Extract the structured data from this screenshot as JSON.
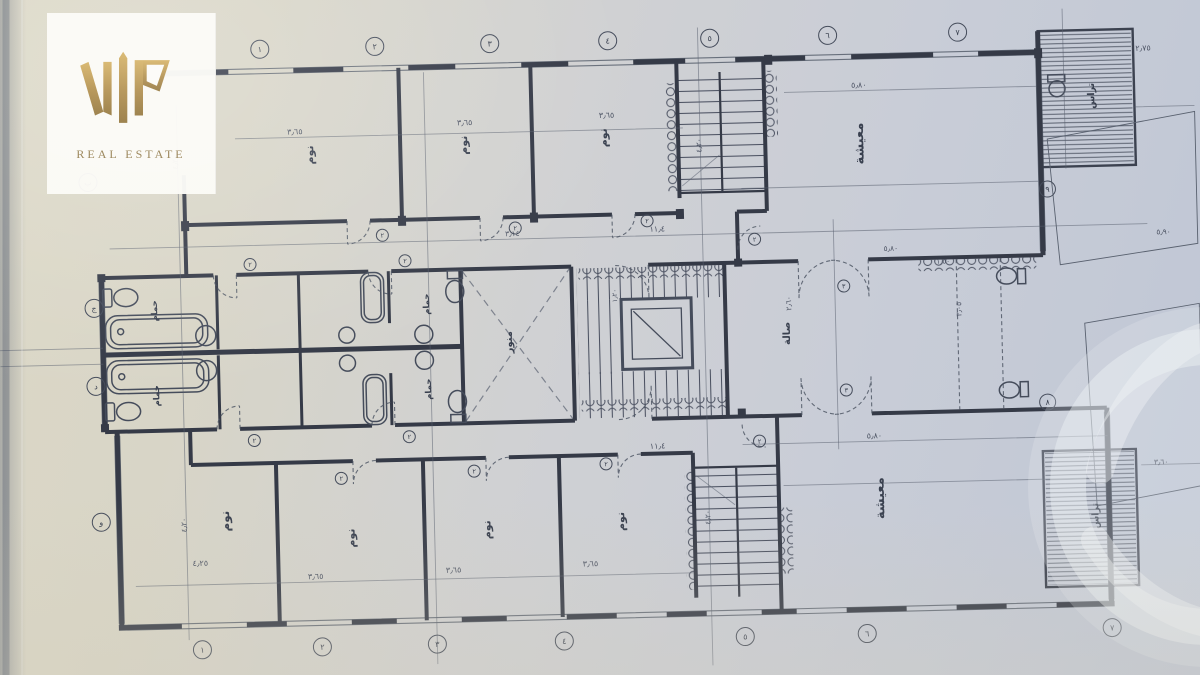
{
  "logo": {
    "monogram": "VIP",
    "subtitle": "REAL ESTATE",
    "gold": "#b08d3e",
    "panel_bg": "#fbfaf6"
  },
  "colors": {
    "paper_warm": "#dcd8c6",
    "paper_cool": "#bfc6d5",
    "ink": "#353a47",
    "thin_line": "#59616f",
    "watermark": "#eef1f4"
  },
  "plan": {
    "texts": [
      {
        "t": "معيشة",
        "x": 868,
        "y": 150,
        "r": -90,
        "s": 13,
        "k": "room"
      },
      {
        "t": "معيشة",
        "x": 880,
        "y": 505,
        "r": -90,
        "s": 13,
        "k": "room"
      },
      {
        "t": "نوم",
        "x": 318,
        "y": 148,
        "r": -90,
        "s": 11,
        "k": "room"
      },
      {
        "t": "نوم",
        "x": 472,
        "y": 142,
        "r": -90,
        "s": 11,
        "k": "room"
      },
      {
        "t": "نوم",
        "x": 612,
        "y": 138,
        "r": -90,
        "s": 11,
        "k": "room"
      },
      {
        "t": "نوم",
        "x": 225,
        "y": 512,
        "r": -90,
        "s": 12,
        "k": "room"
      },
      {
        "t": "نوم",
        "x": 350,
        "y": 532,
        "r": -90,
        "s": 11,
        "k": "room"
      },
      {
        "t": "نوم",
        "x": 486,
        "y": 527,
        "r": -90,
        "s": 11,
        "k": "room"
      },
      {
        "t": "نوم",
        "x": 620,
        "y": 522,
        "r": -90,
        "s": 11,
        "k": "room"
      },
      {
        "t": "منور",
        "x": 512,
        "y": 340,
        "r": -90,
        "s": 10,
        "k": "room"
      },
      {
        "t": "صالة",
        "x": 790,
        "y": 338,
        "r": -90,
        "s": 10,
        "k": "room"
      },
      {
        "t": "حمام",
        "x": 158,
        "y": 300,
        "r": -90,
        "s": 8.5,
        "k": "room"
      },
      {
        "t": "حمام",
        "x": 158,
        "y": 385,
        "r": -90,
        "s": 8.5,
        "k": "room"
      },
      {
        "t": "حمام",
        "x": 430,
        "y": 300,
        "r": -90,
        "s": 8.5,
        "k": "room"
      },
      {
        "t": "حمام",
        "x": 430,
        "y": 385,
        "r": -90,
        "s": 8.5,
        "k": "room"
      },
      {
        "t": "تراس",
        "x": 1100,
        "y": 108,
        "r": -90,
        "s": 9.5,
        "k": "room"
      },
      {
        "t": "تراس",
        "x": 1094,
        "y": 528,
        "r": -90,
        "s": 9.5,
        "k": "room"
      },
      {
        "t": "٣٫٦٥",
        "x": 300,
        "y": 127,
        "s": 8,
        "k": "dim"
      },
      {
        "t": "٣٫٦٥",
        "x": 470,
        "y": 122,
        "s": 8,
        "k": "dim"
      },
      {
        "t": "٣٫٦٥",
        "x": 612,
        "y": 118,
        "s": 8,
        "k": "dim"
      },
      {
        "t": "٥٫٨٠",
        "x": 865,
        "y": 94,
        "s": 8,
        "k": "dim"
      },
      {
        "t": "١١٫٤",
        "x": 660,
        "y": 233,
        "s": 8,
        "k": "dim"
      },
      {
        "t": "٣٫١٤",
        "x": 515,
        "y": 234,
        "s": 7.5,
        "k": "dim"
      },
      {
        "t": "٥٫٨٠",
        "x": 893,
        "y": 258,
        "s": 7.5,
        "k": "dim"
      },
      {
        "t": "١٫٥٠",
        "x": 945,
        "y": 272,
        "s": 7,
        "k": "dim"
      },
      {
        "t": "٥٫٨٠",
        "x": 872,
        "y": 445,
        "s": 8,
        "k": "dim"
      },
      {
        "t": "١١٫٤",
        "x": 655,
        "y": 450,
        "s": 8,
        "k": "dim"
      },
      {
        "t": "٣٫٦٥",
        "x": 310,
        "y": 572,
        "s": 8,
        "k": "dim"
      },
      {
        "t": "٣٫٦٥",
        "x": 448,
        "y": 569,
        "s": 8,
        "k": "dim"
      },
      {
        "t": "٣٫٦٥",
        "x": 585,
        "y": 566,
        "s": 8,
        "k": "dim"
      },
      {
        "t": "٤٫٢٥",
        "x": 195,
        "y": 556,
        "s": 8,
        "k": "dim"
      },
      {
        "t": "٢٫٧٥",
        "x": 1150,
        "y": 64,
        "s": 8,
        "k": "dim"
      },
      {
        "t": "٥٫٩٠",
        "x": 1166,
        "y": 248,
        "s": 7.5,
        "k": "dim"
      },
      {
        "t": "٣٫٦٠",
        "x": 1158,
        "y": 478,
        "s": 7.5,
        "k": "dim"
      },
      {
        "t": "٤٫٢٠",
        "x": 182,
        "y": 152,
        "r": -90,
        "s": 7.5,
        "k": "dim"
      },
      {
        "t": "٤٫٢٠",
        "x": 182,
        "y": 515,
        "r": -90,
        "s": 7.5,
        "k": "dim"
      },
      {
        "t": "٤٫٢٠",
        "x": 706,
        "y": 148,
        "r": -90,
        "s": 7.5,
        "k": "dim"
      },
      {
        "t": "٤٫٢٠",
        "x": 706,
        "y": 520,
        "r": -90,
        "s": 7.5,
        "k": "dim"
      },
      {
        "t": "٢٫٦٠",
        "x": 792,
        "y": 308,
        "r": -90,
        "s": 7.5,
        "k": "dim"
      },
      {
        "t": "٣٫٠٥",
        "x": 962,
        "y": 318,
        "r": -90,
        "s": 7.5,
        "k": "dim"
      },
      {
        "t": "١٫٢٠",
        "x": 618,
        "y": 296,
        "r": -90,
        "s": 7,
        "k": "dim"
      },
      {
        "t": "١",
        "x": 267,
        "y": 41,
        "c": 9,
        "s": 8,
        "k": "bub"
      },
      {
        "t": "٢",
        "x": 382,
        "y": 41,
        "c": 9,
        "s": 8,
        "k": "bub"
      },
      {
        "t": "٣",
        "x": 497,
        "y": 41,
        "c": 9,
        "s": 8,
        "k": "bub"
      },
      {
        "t": "٤",
        "x": 615,
        "y": 41,
        "c": 9,
        "s": 8,
        "k": "bub"
      },
      {
        "t": "٥",
        "x": 717,
        "y": 41,
        "c": 9,
        "s": 8,
        "k": "bub"
      },
      {
        "t": "٦",
        "x": 835,
        "y": 41,
        "c": 9,
        "s": 8,
        "k": "bub"
      },
      {
        "t": "٧",
        "x": 965,
        "y": 41,
        "c": 9,
        "s": 8,
        "k": "bub"
      },
      {
        "t": "١",
        "x": 195,
        "y": 640,
        "c": 9,
        "s": 8,
        "k": "bub"
      },
      {
        "t": "٢",
        "x": 315,
        "y": 640,
        "c": 9,
        "s": 8,
        "k": "bub"
      },
      {
        "t": "٣",
        "x": 430,
        "y": 640,
        "c": 9,
        "s": 8,
        "k": "bub"
      },
      {
        "t": "٤",
        "x": 557,
        "y": 640,
        "c": 9,
        "s": 8,
        "k": "bub"
      },
      {
        "t": "٥",
        "x": 738,
        "y": 640,
        "c": 9,
        "s": 8,
        "k": "bub"
      },
      {
        "t": "٦",
        "x": 860,
        "y": 640,
        "c": 9,
        "s": 8,
        "k": "bub"
      },
      {
        "t": "٧",
        "x": 1105,
        "y": 640,
        "c": 9,
        "s": 8,
        "k": "bub"
      },
      {
        "t": "ب",
        "x": 92,
        "y": 170,
        "c": 9,
        "s": 8,
        "k": "bub"
      },
      {
        "t": "ج",
        "x": 95,
        "y": 296,
        "c": 9,
        "s": 8,
        "k": "bub"
      },
      {
        "t": "د",
        "x": 95,
        "y": 374,
        "c": 9,
        "s": 8,
        "k": "bub"
      },
      {
        "t": "و",
        "x": 97,
        "y": 510,
        "c": 9,
        "s": 8,
        "k": "bub"
      },
      {
        "t": "٨",
        "x": 1046,
        "y": 413,
        "c": 8,
        "s": 8,
        "k": "bub"
      },
      {
        "t": "٩",
        "x": 1051,
        "y": 200,
        "c": 8,
        "s": 8,
        "k": "bub"
      },
      {
        "t": "٢",
        "x": 385,
        "y": 230,
        "c": 6,
        "s": 6.5,
        "k": "bub"
      },
      {
        "t": "٢",
        "x": 518,
        "y": 226,
        "c": 6,
        "s": 6.5,
        "k": "bub"
      },
      {
        "t": "٢",
        "x": 650,
        "y": 222,
        "c": 6,
        "s": 6.5,
        "k": "bub"
      },
      {
        "t": "٢",
        "x": 252,
        "y": 256,
        "c": 6,
        "s": 6.5,
        "k": "bub"
      },
      {
        "t": "٢",
        "x": 407,
        "y": 256,
        "c": 6,
        "s": 6.5,
        "k": "bub"
      },
      {
        "t": "٢",
        "x": 252,
        "y": 432,
        "c": 6,
        "s": 6.5,
        "k": "bub"
      },
      {
        "t": "٢",
        "x": 407,
        "y": 432,
        "c": 6,
        "s": 6.5,
        "k": "bub"
      },
      {
        "t": "٢",
        "x": 338,
        "y": 472,
        "c": 6,
        "s": 6.5,
        "k": "bub"
      },
      {
        "t": "٢",
        "x": 471,
        "y": 468,
        "c": 6,
        "s": 6.5,
        "k": "bub"
      },
      {
        "t": "٢",
        "x": 603,
        "y": 464,
        "c": 6,
        "s": 6.5,
        "k": "bub"
      },
      {
        "t": "٣",
        "x": 845,
        "y": 292,
        "c": 6,
        "s": 6.5,
        "k": "bub"
      },
      {
        "t": "٣",
        "x": 845,
        "y": 396,
        "c": 6,
        "s": 6.5,
        "k": "bub"
      },
      {
        "t": "٢",
        "x": 757,
        "y": 243,
        "c": 6,
        "s": 6.5,
        "k": "bub"
      },
      {
        "t": "٢",
        "x": 757,
        "y": 445,
        "c": 6,
        "s": 6.5,
        "k": "bub"
      }
    ]
  }
}
